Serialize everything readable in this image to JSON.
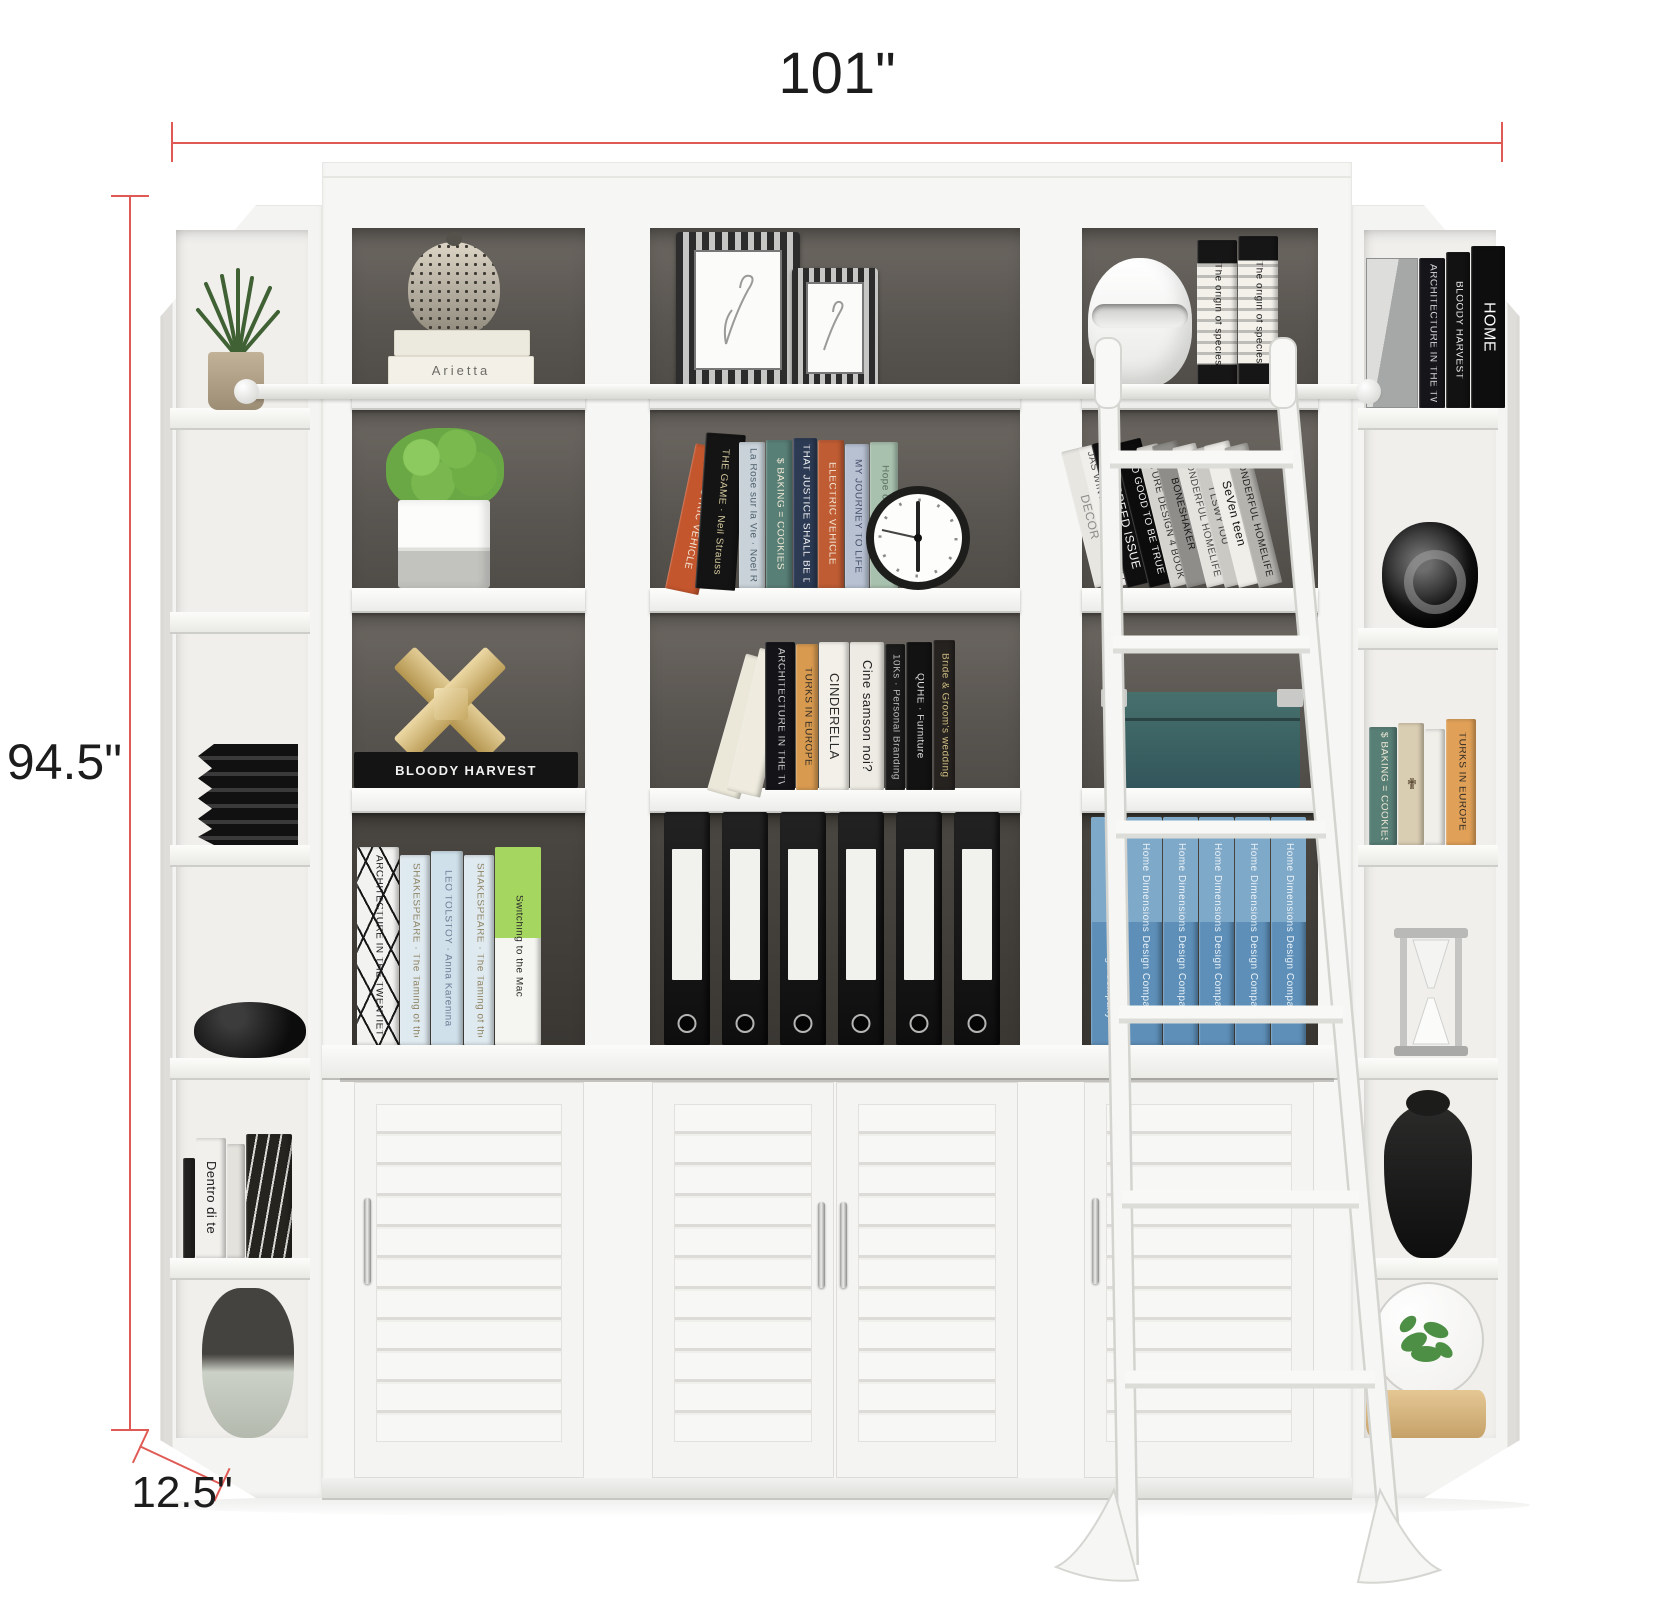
{
  "annotations": {
    "width": "101\"",
    "height": "94.5\"",
    "depth": "12.5\""
  },
  "colors": {
    "dimension_line": "#e05a55",
    "furniture_white": "#f6f6f4",
    "interior_dark": "#5a5550",
    "book_blue": "#5d8fb8",
    "box_teal": "#47706d",
    "gold": "#c8ab6a"
  },
  "left_corner": {
    "objects": [
      "grass-plant-in-pot",
      "black-ribbed-vase",
      "black-stone-bowl",
      "book-stack",
      "two-tone-vase"
    ],
    "books": [
      {
        "w": 12,
        "h": 100,
        "c": "#23211f",
        "t": "",
        "tc": "#ccc"
      },
      {
        "w": 30,
        "h": 120,
        "c": "#f2f0ed",
        "t": "Dentro di te",
        "tc": "#1b1b1b",
        "fs": 13
      },
      {
        "w": 18,
        "h": 114,
        "c": "#e4e2dd",
        "t": "",
        "tc": "#555"
      },
      {
        "w": 46,
        "h": 124,
        "c": "#26241f",
        "t": "",
        "tc": "#bbb",
        "pat": "geo2"
      }
    ]
  },
  "bay1": {
    "book_stack_label": "Arietta",
    "black_book_label": "BLOODY HARVEST",
    "objects": [
      "speckled-vase",
      "green-plant-white-pot",
      "gold-puzzle-sculpture"
    ],
    "shelf4_books": [
      {
        "w": 42,
        "h": 198,
        "c": "#f2f2f0",
        "t": "ARCHITECTURE IN THE TWENTIETH CENTURY",
        "tc": "#1c1c1c",
        "pat": "geo"
      },
      {
        "w": 30,
        "h": 190,
        "c": "#dfeaf0",
        "t": "SHAKESPEARE · The Taming of the Shrew",
        "tc": "#8f8465"
      },
      {
        "w": 32,
        "h": 194,
        "c": "#cfe0ea",
        "t": "LEO TOLSTOY · Anna Karenina",
        "tc": "#6f7d95"
      },
      {
        "w": 30,
        "h": 190,
        "c": "#dfeaf0",
        "t": "SHAKESPEARE · The Taming of the Shrew",
        "tc": "#8f8465"
      },
      {
        "w": 46,
        "h": 198,
        "c": "#f5f5f1",
        "t": "Switching to the Mac",
        "tc": "#2b2b2b",
        "band": "#a5d65f"
      }
    ]
  },
  "bay2": {
    "objects": [
      "ornate-picture-frame-large",
      "ornate-picture-frame-small",
      "black-wall-clock",
      "cream-leaning-boxes",
      "black-binders"
    ],
    "shelf2_books": [
      {
        "w": 34,
        "h": 148,
        "c": "#c4562e",
        "t": "ELECTRIC VEHICLE",
        "tc": "#f4e9d8",
        "lean": 12
      },
      {
        "w": 40,
        "h": 156,
        "c": "#141414",
        "t": "THE GAME · Neil Strauss",
        "tc": "#d6cba0",
        "lean": 4,
        "mt": -4
      },
      {
        "w": 26,
        "h": 146,
        "c": "#c8d2d8",
        "t": "La Rose sur la Vie · Noel Rieger",
        "tc": "#50616e",
        "mt": 4
      },
      {
        "w": 26,
        "h": 148,
        "c": "#587f76",
        "t": "$ BAKING = COOKIES",
        "tc": "#efe8d5"
      },
      {
        "w": 24,
        "h": 150,
        "c": "#2c3a54",
        "t": "THAT JUSTICE SHALL BE DONE",
        "tc": "#f2f2f2"
      },
      {
        "w": 26,
        "h": 148,
        "c": "#bf5c33",
        "t": "ELECTRIC VEHICLE",
        "tc": "#f4e9d8"
      },
      {
        "w": 24,
        "h": 144,
        "c": "#b7c1d2",
        "t": "MY JOURNEY TO LIFE",
        "tc": "#45506a"
      },
      {
        "w": 28,
        "h": 146,
        "c": "#a8c0ae",
        "t": "Hope of Giving Yulia",
        "tc": "#5c7060"
      }
    ],
    "shelf3_books": [
      {
        "w": 34,
        "h": 142,
        "c": "#ebe8da",
        "t": "",
        "lean": 16
      },
      {
        "w": 34,
        "h": 146,
        "c": "#efecdf",
        "t": "",
        "lean": 13,
        "mt": -14
      },
      {
        "w": 30,
        "h": 148,
        "c": "#141418",
        "t": "ARCHITECTURE IN THE TWENTIETH CENTURY",
        "tc": "#cfcfcf",
        "mt": 4
      },
      {
        "w": 22,
        "h": 146,
        "c": "#d89a4f",
        "t": "TURKS IN EUROPE",
        "tc": "#2e2a24"
      },
      {
        "w": 30,
        "h": 148,
        "c": "#f2f0e9",
        "t": "CINDERELLA",
        "tc": "#2b2b2b",
        "fs": 13
      },
      {
        "w": 34,
        "h": 148,
        "c": "#edebe3",
        "t": "Cine samson noi?",
        "tc": "#1e1e1e",
        "fs": 13
      },
      {
        "w": 20,
        "h": 146,
        "c": "#1b1b1b",
        "t": "10Ks · Personal Branding",
        "tc": "#b9b9b9"
      },
      {
        "w": 26,
        "h": 148,
        "c": "#121212",
        "t": "QUHE · Furniture",
        "tc": "#e0e0e0"
      },
      {
        "w": 22,
        "h": 150,
        "c": "#262220",
        "t": "Bride & Groom's wedding",
        "tc": "#cdbb80"
      }
    ],
    "binders": {
      "count": 6
    }
  },
  "bay3": {
    "objects": [
      "white-sculpture-vase",
      "teal-storage-box",
      "white-library-ladder"
    ],
    "shelf1_books": [
      {
        "w": 40,
        "h": 148,
        "c": "#f3f1ea",
        "t": "The origin of species",
        "tc": "#1d1d1d",
        "pat": "orn"
      },
      {
        "w": 40,
        "h": 152,
        "c": "#f3f1ea",
        "t": "The origin of species",
        "tc": "#1d1d1d",
        "pat": "orn"
      }
    ],
    "shelf2_books": [
      {
        "w": 24,
        "h": 140,
        "c": "#e8e6e1",
        "t": "DECOR",
        "tc": "#8b8b89",
        "fs": 12,
        "lean": -14
      },
      {
        "w": 20,
        "h": 144,
        "c": "#f1efeb",
        "t": "JAS WINTER IS. NOT SO COLD",
        "tc": "#555",
        "lean": -14,
        "mt": -6
      },
      {
        "w": 28,
        "h": 148,
        "c": "#0f0f0f",
        "t": "THE SPEED ISSUE",
        "tc": "#f5f5f5",
        "fs": 12,
        "lean": -14,
        "mt": -6
      },
      {
        "w": 28,
        "h": 148,
        "c": "#0c0c0c",
        "t": "TOO GOOD TO BE TRUE",
        "tc": "#f0f0f0",
        "lean": -14,
        "mt": -6
      },
      {
        "w": 22,
        "h": 144,
        "c": "#d5d3cd",
        "t": "FUTURE DESIGN 4 BOOKS",
        "tc": "#333",
        "lean": -14,
        "mt": -6
      },
      {
        "w": 26,
        "h": 146,
        "c": "#8f8d89",
        "t": "BONESHAKER",
        "tc": "#141414",
        "lean": -14,
        "mt": -6
      },
      {
        "w": 24,
        "h": 144,
        "c": "#e5e3de",
        "t": "WONDERFUL HOMELIFE",
        "tc": "#4a4a48",
        "lean": -14,
        "mt": -6
      },
      {
        "w": 20,
        "h": 142,
        "c": "#cbc9c4",
        "t": "I LSWY IOU",
        "tc": "#3a3a38",
        "lean": -14,
        "mt": -6
      },
      {
        "w": 26,
        "h": 146,
        "c": "#f0eee8",
        "t": "SeVen teen",
        "tc": "#141414",
        "fs": 12,
        "lean": -14,
        "mt": -6
      },
      {
        "w": 24,
        "h": 144,
        "c": "#b5b3ae",
        "t": "WONDERFUL HOMELIFE",
        "tc": "#222",
        "lean": -14,
        "mt": -6
      }
    ],
    "shelf4_books": [
      {
        "w": 35,
        "h": 228,
        "c": "#5d8fb8",
        "t": "Home Dimensions Design Company",
        "tc": "#eaf2f8",
        "band": "#7fa9c9"
      },
      {
        "w": 35,
        "h": 228,
        "c": "#5d8fb8",
        "t": "Home Dimensions Design Company",
        "tc": "#eaf2f8",
        "band": "#7fa9c9"
      },
      {
        "w": 35,
        "h": 228,
        "c": "#5d8fb8",
        "t": "Home Dimensions Design Company",
        "tc": "#eaf2f8",
        "band": "#7fa9c9"
      },
      {
        "w": 35,
        "h": 228,
        "c": "#5d8fb8",
        "t": "Home Dimensions Design Company",
        "tc": "#eaf2f8",
        "band": "#7fa9c9"
      },
      {
        "w": 35,
        "h": 228,
        "c": "#5d8fb8",
        "t": "Home Dimensions Design Company",
        "tc": "#eaf2f8",
        "band": "#7fa9c9"
      },
      {
        "w": 35,
        "h": 228,
        "c": "#5d8fb8",
        "t": "Home Dimensions Design Company",
        "tc": "#eaf2f8",
        "band": "#7fa9c9"
      }
    ]
  },
  "right_corner": {
    "objects": [
      "silver-box",
      "black-glossy-vase",
      "silver-hourglass",
      "black-ceramic-jug",
      "glass-terrarium-with-plant"
    ],
    "shelf1_books": [
      {
        "w": 26,
        "h": 150,
        "c": "#16161a",
        "t": "ARCHITECTURE IN THE TWENTIETH CENTURY",
        "tc": "#d8d8d8"
      },
      {
        "w": 24,
        "h": 156,
        "c": "#121212",
        "t": "BLOODY HARVEST",
        "tc": "#ececec"
      },
      {
        "w": 34,
        "h": 162,
        "c": "#0e0e0e",
        "t": "HOME",
        "tc": "#fafafa",
        "fs": 16
      }
    ],
    "shelf3_books": [
      {
        "w": 28,
        "h": 118,
        "c": "#587f76",
        "t": "$ BAKING = COOKIES",
        "tc": "#efe8d5"
      },
      {
        "w": 26,
        "h": 122,
        "c": "#d9cdb2",
        "t": "✟",
        "tc": "#5c4a34",
        "fs": 15
      },
      {
        "w": 20,
        "h": 116,
        "c": "#f1efe9",
        "t": "",
        "tc": "#888"
      },
      {
        "w": 30,
        "h": 126,
        "c": "#e0a057",
        "t": "TURKS IN EUROPE",
        "tc": "#2e2a24"
      }
    ]
  }
}
